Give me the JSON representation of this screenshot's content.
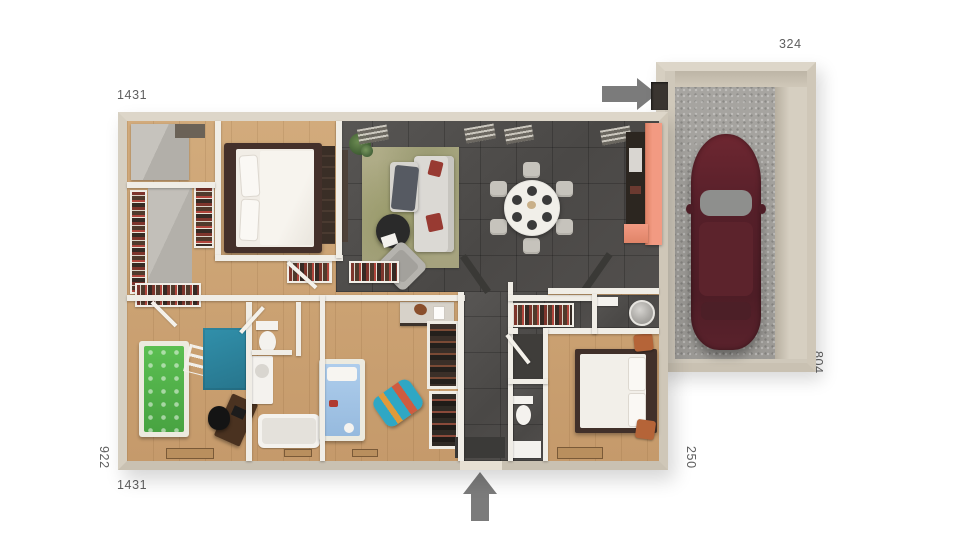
{
  "dimensions": {
    "top_width": "1431",
    "garage_width": "324",
    "left_height": "922",
    "bottom_width": "1431",
    "entry_width": "250",
    "garage_depth": "804"
  },
  "arrows": {
    "garage_entry_direction": "right",
    "main_entrance_direction": "up"
  },
  "palette": {
    "background": "#ffffff",
    "wall_outer": "#d8d1c4",
    "wall_inner": "#f0ede6",
    "wood_floor": "#c9a171",
    "tile_floor": "#4f4d4b",
    "living_rug": "#aaa782",
    "teal_rug": "#2b86a0",
    "green_bed": "#53b14a",
    "blue_bed": "#a6c8e8",
    "kitchen_counter_accent": "#ef957e",
    "kitchen_cabinet": "#2c2620",
    "sofa": "#dbd9d4",
    "accent_cushion": "#983a32",
    "dining_table": "#f1efe9",
    "bed_frame_dark": "#41302a",
    "pouf_orange": "#b56438",
    "car_body": "#5a2230",
    "garage_floor": "#a3a19d",
    "label_text": "#5f5f5f",
    "arrow": "#7b7b7b"
  }
}
